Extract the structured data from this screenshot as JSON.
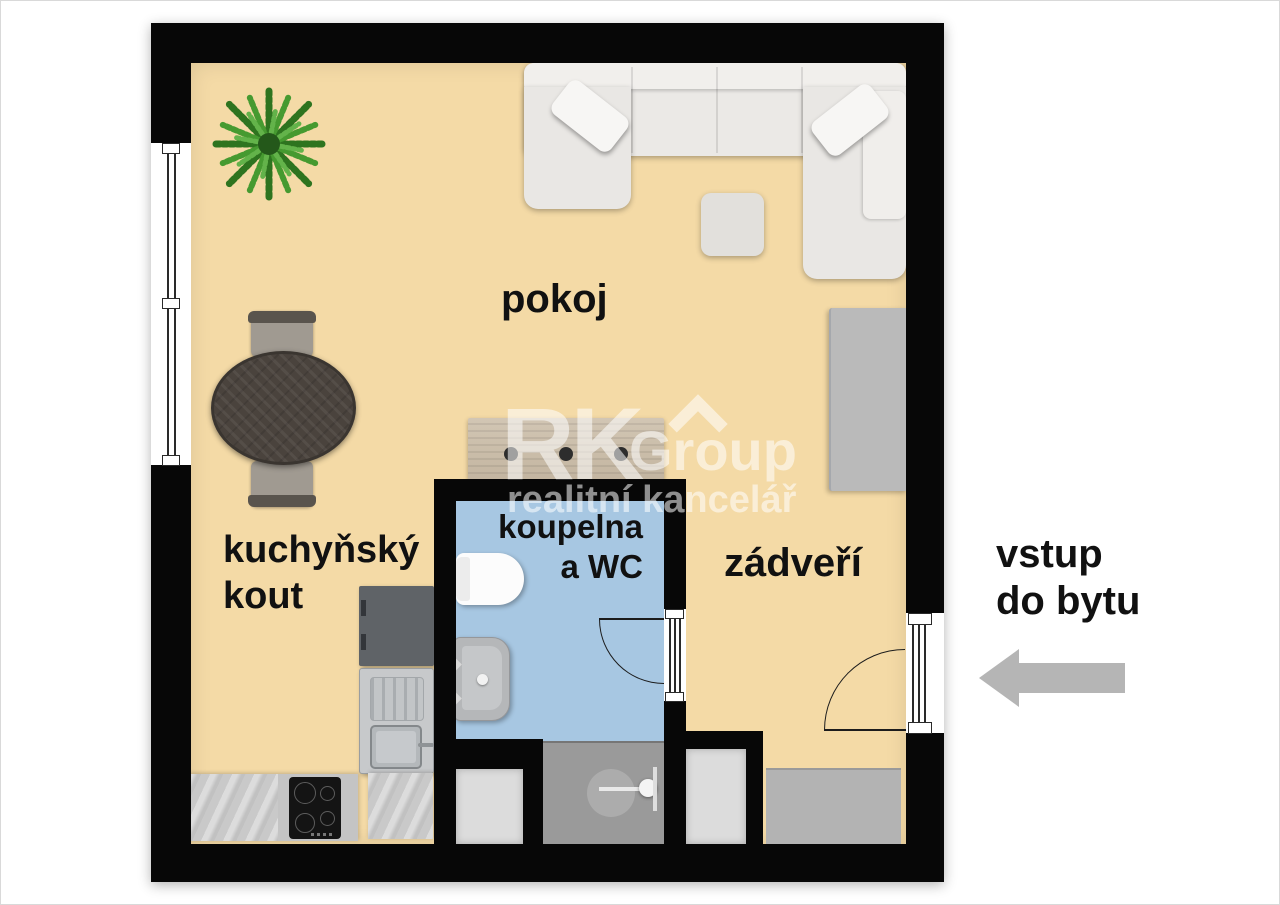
{
  "rooms": {
    "living": {
      "label": "pokoj"
    },
    "kitchen": {
      "line1": "kuchyňský",
      "line2": "kout"
    },
    "bathroom": {
      "line1": "koupelna",
      "line2": "a WC"
    },
    "hallway": {
      "label": "zádveří"
    }
  },
  "entrance_note": {
    "line1": "vstup",
    "line2": "do bytu"
  },
  "watermark": {
    "initials": "RK",
    "name": "Group",
    "subtitle": "realitní kancelář"
  },
  "colors": {
    "floor": "#f4daa6",
    "bathroom_floor": "#a7c7e2",
    "wall": "#070707",
    "shower": "#9a9a9a",
    "shaft": "#dcdcdc",
    "doormat": "#b3b3b3",
    "arrow": "#b5b5b5",
    "label_text": "#111111",
    "sofa": "#ebe9e6",
    "wardrobe": "#bababa",
    "fridge": "#5f6367"
  }
}
